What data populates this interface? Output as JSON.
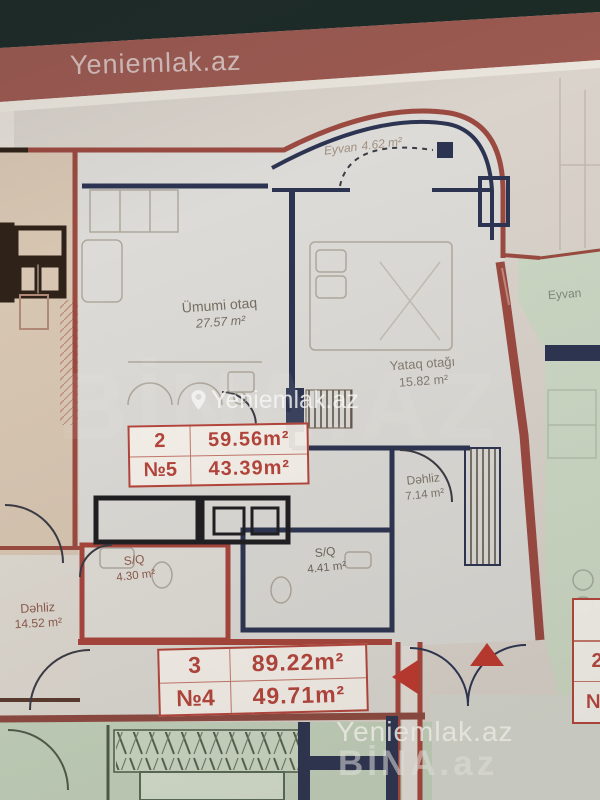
{
  "watermarks": {
    "top": "Yeniemlak.az",
    "ghost": "BİNA.AZ",
    "center": "Yeniemlak.az",
    "bottom_site": "Yeniemlak.az",
    "bottom_brand": "BİNA.az"
  },
  "rooms": {
    "eyvan_top": {
      "name": "Eyvan",
      "area": "4.62 m²"
    },
    "umumi_otaq": {
      "name": "Ümumi otaq",
      "area": "27.57 m²"
    },
    "yataq_otagi": {
      "name": "Yataq otağı",
      "area": "15.82 m²"
    },
    "dehliz_right": {
      "name": "Dəhliz",
      "area": "7.14 m²"
    },
    "sq_left": {
      "name": "S/Q",
      "area": "4.30 m²"
    },
    "sq_mid": {
      "name": "S/Q",
      "area": "4.41 m²"
    },
    "dehliz_left": {
      "name": "Dəhliz",
      "area": "14.52 m²"
    },
    "eyvan_right": {
      "name": "Eyvan"
    }
  },
  "tables": {
    "apartment_2": {
      "rows": [
        [
          "2",
          "59.56m²"
        ],
        [
          "№5",
          "43.39m²"
        ]
      ]
    },
    "apartment_3": {
      "rows": [
        [
          "3",
          "89.22m²"
        ],
        [
          "№4",
          "49.71m²"
        ]
      ]
    },
    "right_partial": {
      "rows": [
        [
          "2"
        ],
        [
          "№"
        ]
      ]
    }
  },
  "colors": {
    "band_dark": "#1d2b27",
    "band_brown": "#9c5a51",
    "wall_red": "#9b4a41",
    "wall_navy": "#2c3452",
    "wall_brown": "#2f2218",
    "table_text": "#b5453c",
    "green_area": "#c9d7c2",
    "beige_area": "#d7c6b2",
    "paper": "#d9d3cb"
  }
}
